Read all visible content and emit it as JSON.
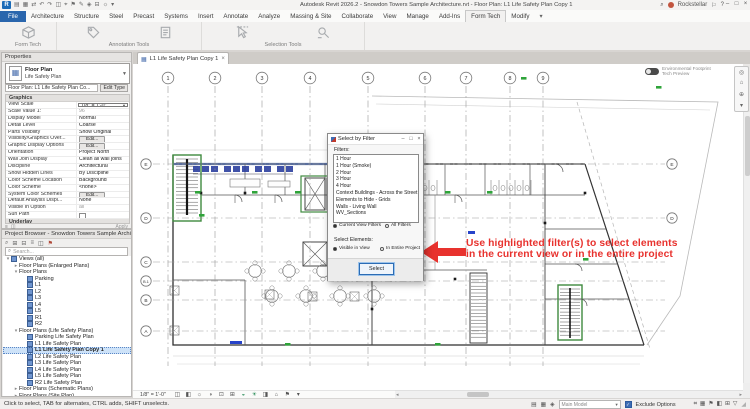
{
  "window": {
    "brand_letter": "R",
    "title": "Autodesk Revit 2026.2 - Snowdon Towers Sample Architecture.rvt - Floor Plan: L1 Life Safety Plan Copy 1",
    "search_glyph": "⌕",
    "user_name": "Rockstellar",
    "qat_icons": [
      {
        "name": "open-icon",
        "glyph": "▤"
      },
      {
        "name": "save-icon",
        "glyph": "▦"
      },
      {
        "name": "sync-icon",
        "glyph": "⇄"
      },
      {
        "name": "undo-icon",
        "glyph": "↶"
      },
      {
        "name": "redo-icon",
        "glyph": "↷"
      },
      {
        "name": "print-icon",
        "glyph": "◫"
      },
      {
        "name": "measure-icon",
        "glyph": "⌖"
      },
      {
        "name": "tag-icon",
        "glyph": "⚑"
      },
      {
        "name": "text-icon",
        "glyph": "✎"
      },
      {
        "name": "default-3d-view-icon",
        "glyph": "◈"
      },
      {
        "name": "section-icon",
        "glyph": "⊟"
      },
      {
        "name": "thin-lines-icon",
        "glyph": "☼"
      },
      {
        "name": "qat-customize-icon",
        "glyph": "▾"
      }
    ],
    "right_icons": [
      {
        "name": "notification-icon",
        "glyph": "⚐"
      },
      {
        "name": "help-icon",
        "glyph": "?"
      }
    ],
    "window_buttons": [
      {
        "name": "minimize-button",
        "glyph": "–"
      },
      {
        "name": "restore-button",
        "glyph": "□"
      },
      {
        "name": "close-button",
        "glyph": "×"
      }
    ]
  },
  "ribbon": {
    "tabs": [
      {
        "label": "File",
        "kind": "file"
      },
      {
        "label": "Architecture"
      },
      {
        "label": "Structure"
      },
      {
        "label": "Steel"
      },
      {
        "label": "Precast"
      },
      {
        "label": "Systems"
      },
      {
        "label": "Insert"
      },
      {
        "label": "Annotate"
      },
      {
        "label": "Analyze"
      },
      {
        "label": "Massing & Site"
      },
      {
        "label": "Collaborate"
      },
      {
        "label": "View"
      },
      {
        "label": "Manage"
      },
      {
        "label": "Add-Ins"
      },
      {
        "label": "Form Tech",
        "kind": "active"
      },
      {
        "label": "Modify"
      }
    ],
    "overflow_glyph": "▾",
    "panels": [
      {
        "label": "Form Tech",
        "width": 56,
        "buttons": [
          {
            "name": "form-tools-button",
            "icon": "cube"
          }
        ]
      },
      {
        "label": "Annotation Tools",
        "width": 144,
        "buttons": [
          {
            "name": "annotation-tag-button",
            "icon": "tag"
          },
          {
            "name": "annotation-note-button",
            "icon": "note"
          }
        ]
      },
      {
        "label": "Selection Tools",
        "width": 162,
        "buttons": [
          {
            "name": "pick-elements-button",
            "icon": "cursor"
          },
          {
            "name": "select-by-filter-button",
            "icon": "filter"
          }
        ]
      }
    ]
  },
  "properties": {
    "header": "Properties",
    "type_selector": {
      "family": "Floor Plan",
      "type": "Life Safety Plan"
    },
    "instance_label": "Floor Plan: L1 Life Safety Plan Co...",
    "edit_type_label": "Edit Type",
    "sections": [
      {
        "title": "Graphics",
        "rows": [
          {
            "name": "View Scale",
            "value": "1/8\" = 1'-0\"",
            "kind": "dropdown"
          },
          {
            "name": "Scale Value    1:",
            "value": "96",
            "kind": "gray"
          },
          {
            "name": "Display Model",
            "value": "Normal",
            "kind": "text"
          },
          {
            "name": "Detail Level",
            "value": "Coarse",
            "kind": "text"
          },
          {
            "name": "Parts Visibility",
            "value": "Show Original",
            "kind": "text"
          },
          {
            "name": "Visibility/Graphics Over...",
            "value": "Edit...",
            "kind": "button"
          },
          {
            "name": "Graphic Display Options",
            "value": "Edit...",
            "kind": "button"
          },
          {
            "name": "Orientation",
            "value": "Project North",
            "kind": "text"
          },
          {
            "name": "Wall Join Display",
            "value": "Clean all wall joins",
            "kind": "text"
          },
          {
            "name": "Discipline",
            "value": "Architectural",
            "kind": "text"
          },
          {
            "name": "Show Hidden Lines",
            "value": "By Discipline",
            "kind": "text"
          },
          {
            "name": "Color Scheme Location",
            "value": "Background",
            "kind": "text"
          },
          {
            "name": "Color Scheme",
            "value": "<none>",
            "kind": "text"
          },
          {
            "name": "System Color Schemes",
            "value": "Edit...",
            "kind": "button"
          },
          {
            "name": "Default Analysis Displ...",
            "value": "None",
            "kind": "text"
          },
          {
            "name": "Visible In Option",
            "value": "all",
            "kind": "gray"
          },
          {
            "name": "Sun Path",
            "value": "",
            "kind": "check"
          }
        ]
      },
      {
        "title": "Underlay",
        "rows": [
          {
            "name": "Range: Base Level",
            "value": "None",
            "kind": "text"
          },
          {
            "name": "Range: Top Level",
            "value": "Unbounded",
            "kind": "text"
          },
          {
            "name": "Underlay Orientation",
            "value": "Look down",
            "kind": "gray"
          }
        ]
      }
    ],
    "strip_icons": [
      {
        "name": "properties-help-icon",
        "glyph": "◫"
      },
      {
        "name": "palette-list-icon",
        "glyph": "≡"
      }
    ],
    "apply_label": "Apply"
  },
  "browser": {
    "header": "Project Browser - Snowdon Towers Sample Architectu...",
    "toolbar_icons": [
      {
        "name": "browser-search-icon",
        "glyph": "⌕"
      },
      {
        "name": "browser-expand-icon",
        "glyph": "⊞"
      },
      {
        "name": "browser-collapse-icon",
        "glyph": "⊟"
      },
      {
        "name": "browser-list-icon",
        "glyph": "≡"
      },
      {
        "name": "browser-settings-icon",
        "glyph": "◫"
      },
      {
        "name": "browser-flag-icon",
        "glyph": "⚑",
        "tint": "#b04a3a"
      }
    ],
    "search_placeholder": "Search...",
    "tree": [
      {
        "label": "Views (all)",
        "depth": 0,
        "expand": "-",
        "icon": "views"
      },
      {
        "label": "Floor Plans (Enlarged Plans)",
        "depth": 1,
        "expand": "+"
      },
      {
        "label": "Floor Plans",
        "depth": 1,
        "expand": "-"
      },
      {
        "label": "Parking",
        "depth": 2,
        "icon": "plan"
      },
      {
        "label": "L1",
        "depth": 2,
        "icon": "plan"
      },
      {
        "label": "L2",
        "depth": 2,
        "icon": "plan"
      },
      {
        "label": "L3",
        "depth": 2,
        "icon": "plan"
      },
      {
        "label": "L4",
        "depth": 2,
        "icon": "plan"
      },
      {
        "label": "L5",
        "depth": 2,
        "icon": "plan"
      },
      {
        "label": "R1",
        "depth": 2,
        "icon": "plan"
      },
      {
        "label": "R2",
        "depth": 2,
        "icon": "plan"
      },
      {
        "label": "Floor Plans (Life Safety Plans)",
        "depth": 1,
        "expand": "-"
      },
      {
        "label": "Parking Life Safety Plan",
        "depth": 2,
        "icon": "plan"
      },
      {
        "label": "L1 Life Safety Plan",
        "depth": 2,
        "icon": "plan"
      },
      {
        "label": "L1 Life Safety Plan Copy 1",
        "depth": 2,
        "icon": "plan",
        "selected": true
      },
      {
        "label": "L2 Life Safety Plan",
        "depth": 2,
        "icon": "plan"
      },
      {
        "label": "L3 Life Safety Plan",
        "depth": 2,
        "icon": "plan"
      },
      {
        "label": "L4 Life Safety Plan",
        "depth": 2,
        "icon": "plan"
      },
      {
        "label": "L5 Life Safety Plan",
        "depth": 2,
        "icon": "plan"
      },
      {
        "label": "R2 Life Safety Plan",
        "depth": 2,
        "icon": "plan"
      },
      {
        "label": "Floor Plans (Schematic Plans)",
        "depth": 1,
        "expand": "+"
      },
      {
        "label": "Floor Plans (Site Plan)",
        "depth": 1,
        "expand": "+"
      }
    ]
  },
  "view_tab": {
    "label": "L1 Life Safety Plan Copy 1",
    "close_glyph": "×",
    "plan_glyph": "▦"
  },
  "canvas": {
    "toggle_line1": "Environmental Footprint",
    "toggle_line2": "Tech Preview",
    "nav_icons": [
      {
        "name": "steering-wheel-icon",
        "glyph": "◎"
      },
      {
        "name": "home-view-icon",
        "glyph": "⌂"
      },
      {
        "name": "zoom-icon",
        "glyph": "⊕"
      },
      {
        "name": "navbar-more-icon",
        "glyph": "▾"
      }
    ]
  },
  "plan": {
    "column_grids": [
      {
        "label": "1",
        "x": 33
      },
      {
        "label": "2",
        "x": 80
      },
      {
        "label": "3",
        "x": 127
      },
      {
        "label": "4",
        "x": 175
      },
      {
        "label": "5",
        "x": 233
      },
      {
        "label": "6",
        "x": 290
      },
      {
        "label": "7",
        "x": 331
      },
      {
        "label": "8",
        "x": 375
      },
      {
        "label": "9",
        "x": 408
      }
    ],
    "row_grids": [
      {
        "label": "E",
        "y": 100,
        "right": true
      },
      {
        "label": "D",
        "y": 154,
        "right": true
      },
      {
        "label": "C",
        "y": 198
      },
      {
        "label": "B.1",
        "y": 217
      },
      {
        "label": "B",
        "y": 236
      },
      {
        "label": "A",
        "y": 267
      }
    ]
  },
  "annotation": {
    "line1": "Use highlighted filter(s) to select elements",
    "line2": "in the current view or in the entire project",
    "color": "#e8322e"
  },
  "dialog": {
    "title": "Select by Filter",
    "window_buttons": [
      {
        "name": "dialog-minimize-button",
        "glyph": "–"
      },
      {
        "name": "dialog-maximize-button",
        "glyph": "□"
      },
      {
        "name": "dialog-close-button",
        "glyph": "×"
      }
    ],
    "filters_label": "Filters:",
    "filters": [
      "1 Hour",
      "1 Hour (Smoke)",
      "2 Hour",
      "3 Hour",
      "4 Hour",
      "Context Buildings - Across the Street",
      "Elements to Hide - Grids",
      "Walls - Living Wall",
      "WV_Sections"
    ],
    "filter_scope": [
      {
        "label": "Current View Filters",
        "selected": true
      },
      {
        "label": "All Filters",
        "selected": false
      }
    ],
    "select_elements_label": "Select Elements:",
    "element_scope": [
      {
        "label": "Visible in View",
        "selected": true
      },
      {
        "label": "In Entire Project",
        "selected": false
      }
    ],
    "select_button": "Select"
  },
  "view_control_bar": {
    "scale": "1/8\" = 1'-0\"",
    "icons": [
      {
        "name": "detail-level-icon",
        "glyph": "◫"
      },
      {
        "name": "visual-style-icon",
        "glyph": "◧"
      },
      {
        "name": "sun-path-icon",
        "glyph": "☼"
      },
      {
        "name": "shadows-icon",
        "glyph": "◑"
      },
      {
        "name": "crop-view-icon",
        "glyph": "⊡"
      },
      {
        "name": "show-crop-icon",
        "glyph": "⊞"
      },
      {
        "name": "temporary-hide-icon",
        "glyph": "◒",
        "tint": true
      },
      {
        "name": "reveal-hidden-icon",
        "glyph": "☀",
        "tint": true
      },
      {
        "name": "temporary-view-properties-icon",
        "glyph": "◨"
      },
      {
        "name": "worksharing-display-icon",
        "glyph": "⌂"
      },
      {
        "name": "constraints-icon",
        "glyph": "⚑"
      },
      {
        "name": "vcb-more-icon",
        "glyph": "▾"
      }
    ]
  },
  "status_bar": {
    "hint": "Click to select, TAB for alternates, CTRL adds, SHIFT unselects.",
    "left_icons": [
      {
        "name": "worksets-icon",
        "glyph": "▤"
      },
      {
        "name": "active-workset-icon",
        "glyph": "▦"
      },
      {
        "name": "design-options-icon",
        "glyph": "◈"
      }
    ],
    "design_option": "Main Model",
    "exclude_label": "Exclude Options",
    "exclude_checked": true,
    "check_glyph": "✓",
    "right_icons": [
      {
        "name": "select-links-icon",
        "glyph": "⌗"
      },
      {
        "name": "select-underlay-icon",
        "glyph": "▦"
      },
      {
        "name": "select-pinned-icon",
        "glyph": "⚑"
      },
      {
        "name": "select-faces-icon",
        "glyph": "◧"
      },
      {
        "name": "drag-select-icon",
        "glyph": "⊞"
      },
      {
        "name": "selection-filter-icon",
        "glyph": "▽"
      }
    ],
    "grip_glyph": "◢"
  },
  "colors": {
    "rated_wall_red": "#9e2f2f",
    "exit_green": "#2fa43a",
    "stair_green": "#3f8a3f",
    "casework_blue": "#2b3f9e",
    "annotation_red": "#e8322e",
    "file_tab_blue": "#2a66ad"
  }
}
